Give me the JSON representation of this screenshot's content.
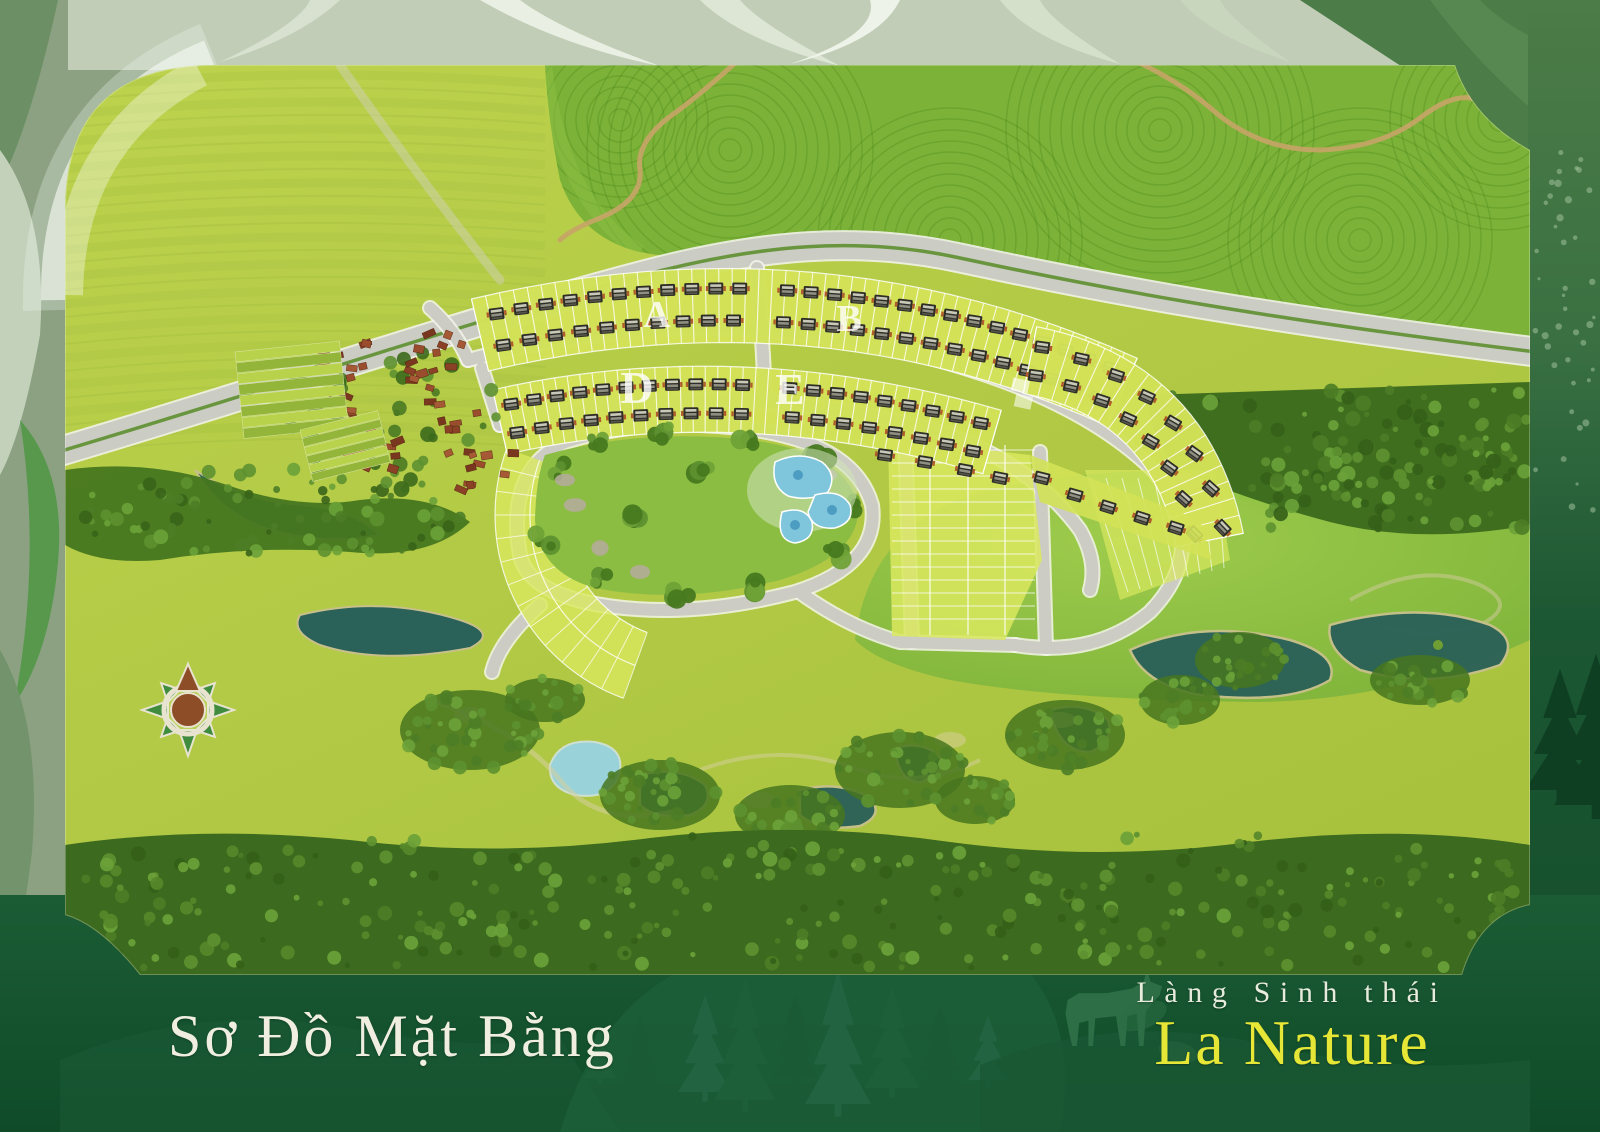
{
  "poster": {
    "plan_title": "Sơ Đồ Mặt Bằng",
    "project_tagline": "Làng Sinh thái",
    "project_name": "La Nature"
  },
  "map": {
    "zones": [
      {
        "label": "A"
      },
      {
        "label": "B"
      },
      {
        "label": "D"
      },
      {
        "label": "E"
      }
    ],
    "icons": {
      "compass": "compass-rose-north-icon"
    }
  },
  "colors": {
    "brand_yellow": "#e5e636",
    "title_cream": "#f0efdf",
    "frame_bottom_green": "#14522d",
    "map_field_green": "#b4cb48",
    "tea_hill_green": "#7cb237",
    "water_teal": "#2a6158",
    "road_gray": "#cbccc3",
    "roof_brown": "#8a4126"
  }
}
